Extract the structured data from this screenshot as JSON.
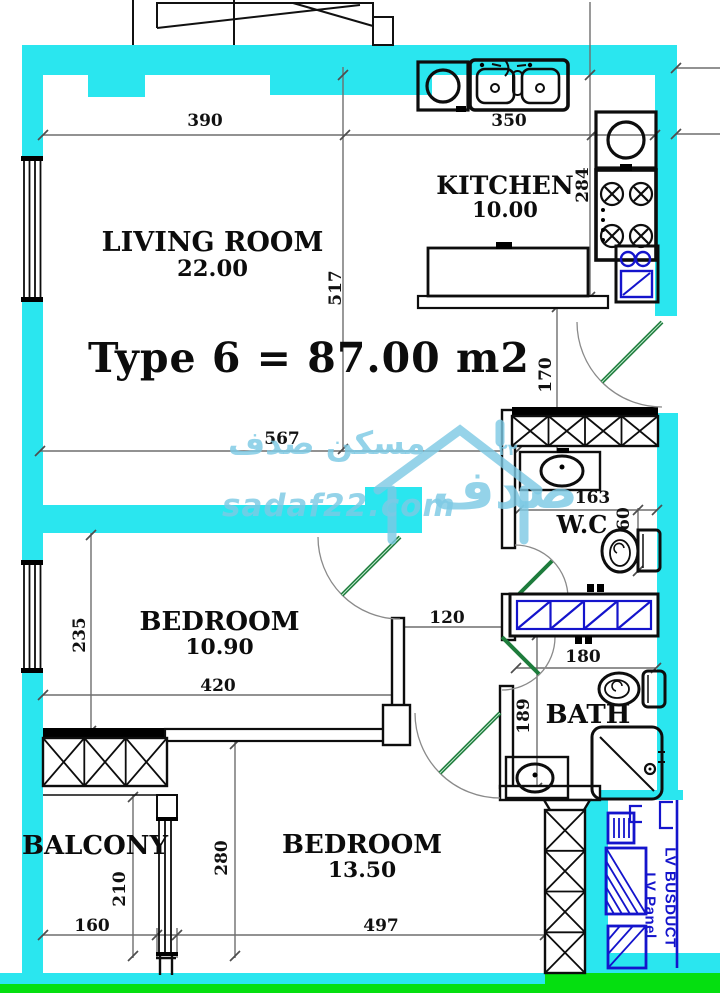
{
  "title": "Type 6 = 87.00 m2",
  "rooms": {
    "living_room": {
      "name": "LIVING  ROOM",
      "area": "22.00"
    },
    "kitchen": {
      "name": "KITCHEN",
      "area": "10.00"
    },
    "bedroom_1": {
      "name": "BEDROOM",
      "area": "10.90"
    },
    "bedroom_2": {
      "name": "BEDROOM",
      "area": "13.50"
    },
    "balcony": {
      "name": "BALCONY"
    },
    "wc": {
      "name": "W.C"
    },
    "bath": {
      "name": "BATH"
    }
  },
  "dims": {
    "d390": "390",
    "d350": "350",
    "d284": "284",
    "d517": "517",
    "d170": "170",
    "d567": "567",
    "d163": "163",
    "d60": "60",
    "d120": "120",
    "d180": "180",
    "d420": "420",
    "d235": "235",
    "d189": "189",
    "d280": "280",
    "d210": "210",
    "d160": "160",
    "d497": "497"
  },
  "electrical": {
    "busduct": "LV  BUSDUCT",
    "panel": "LV  Panel"
  },
  "watermark": {
    "brand_ar": "مسكن صدف",
    "logo_ar": "صدف",
    "url": "sadaf22.com",
    "badge": "٢٢"
  },
  "colors": {
    "wall": "#2ae6ef",
    "base_strip": "#05df10",
    "door_leaf": "#1e7c3c",
    "electrical_blue": "#1414cc",
    "dimension_gray": "#6e6e6e",
    "watermark_blue": "#7dc9e4"
  }
}
